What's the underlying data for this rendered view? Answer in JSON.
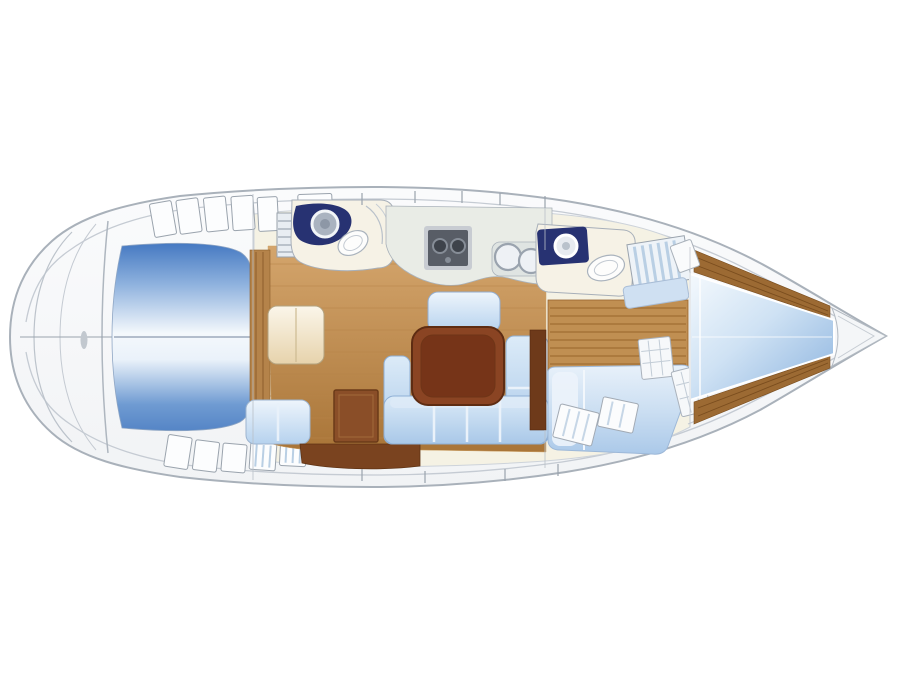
{
  "page": {
    "background": "#ffffff",
    "description": "Top-view interior layout plan of a sailing yacht, bow to the right, stern to the left. No text labels are rendered in the drawing."
  },
  "diagram": {
    "type": "boat-floor-plan",
    "orientation": {
      "bow": "right",
      "stern": "left"
    },
    "palette": {
      "hullFill": "#f8f9fb",
      "hullStroke": "#a9b1ba",
      "deckLine": "#c5cbd3",
      "interiorCream": "#f5f2e4",
      "cockpitDivider": "#8d9aaf",
      "woodFloor": "#cda166",
      "woodTrim": "#b5834a",
      "slatWood": "#c08f52",
      "vberthWood": "#9c6a33",
      "tableBrown": "#8a4423",
      "tableBorder": "#5e2c12",
      "cabinetBrown": "#8a4e28",
      "bottomLocker": "#7a431f",
      "navyFixture": "#273272",
      "counterSage": "#e9ece6",
      "stoveDark": "#585d66",
      "stoveFrame": "#c8ccd2",
      "sinkGrey": "#aab3c0",
      "toiletWhite": "#fdfdfc",
      "toiletStroke": "#aab3bd",
      "stripeBlue": "#b9cfe4",
      "hatchWhite": "#fbfcfd",
      "lockerStroke": "#9aa3ad",
      "chartTable": "#efe0bd",
      "bowTip": "#f4f6f8",
      "roomFloor": "#f6f2e6",
      "benchBlue": "#cfe0f2",
      "setteeEdge": "#8fb0d6",
      "bedEdge": "#9db8d8"
    },
    "regions": [
      {
        "id": "swim-platform",
        "kind": "stern transom arcs"
      },
      {
        "id": "cockpit",
        "kind": "blue seating well with centerline"
      },
      {
        "id": "deck-lockers",
        "kind": "rows of small lockers beside cockpit"
      },
      {
        "id": "companionway",
        "kind": "steps down to saloon"
      },
      {
        "id": "aft-head",
        "kind": "toilet + navy vanity with round sink + shower"
      },
      {
        "id": "galley",
        "kind": "counter with 2-burner stove and twin round sinks"
      },
      {
        "id": "saloon",
        "kind": "wood sole, U-settee, dark table, forward bench seat"
      },
      {
        "id": "chart-table",
        "kind": "nav table with seat to port"
      },
      {
        "id": "storage-cabinet",
        "kind": "dark wood cabinet in saloon"
      },
      {
        "id": "forward-head",
        "kind": "navy vanity with round sink + toilet"
      },
      {
        "id": "wardrobe",
        "kind": "striped shelved locker"
      },
      {
        "id": "dresser",
        "kind": "slatted unit with louvered doors"
      },
      {
        "id": "starboard-berth",
        "kind": "double berth with pillows"
      },
      {
        "id": "v-berth",
        "kind": "tapered bow berth with wood side shelves"
      },
      {
        "id": "anchor-locker",
        "kind": "white bow tip locker"
      }
    ]
  }
}
